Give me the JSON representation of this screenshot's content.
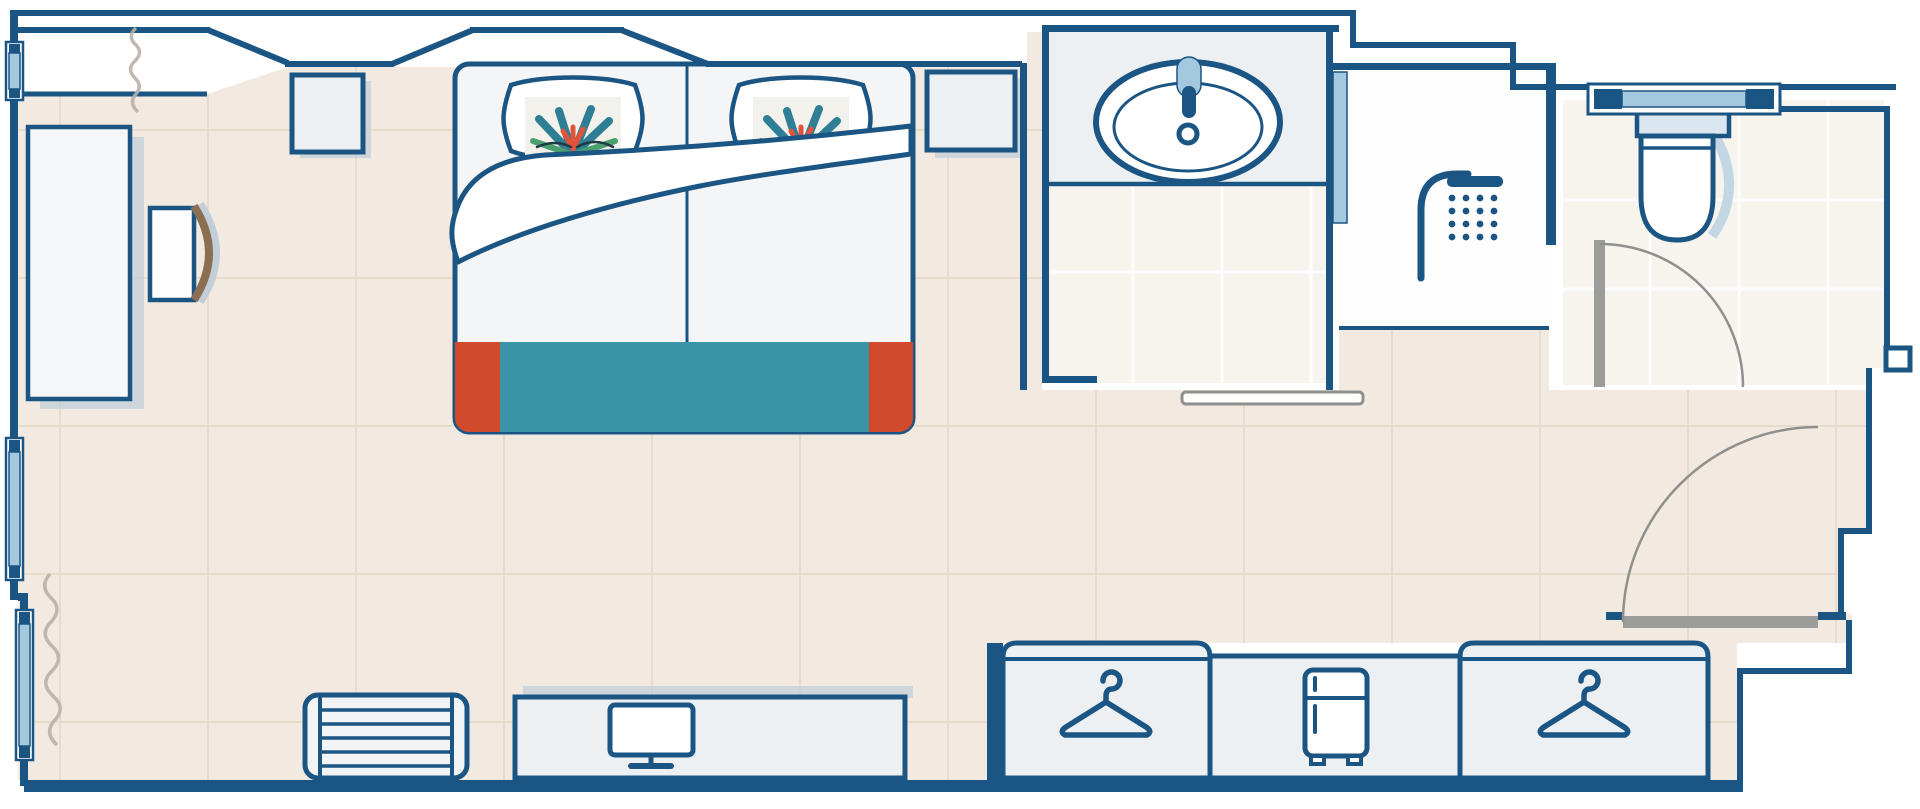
{
  "title": "Hotel room floor plan",
  "colors": {
    "wall": "#1b5583",
    "accent_light_blue": "#a4c9de",
    "mid_blue": "#4a87b0",
    "floor_beige": "#f2e9e0",
    "floor_grid": "#e6d9c9",
    "bath_floor": "#f7f4ee",
    "furniture_fill": "#edf0f2",
    "white": "#ffffff",
    "bedding_teal": "#3a93a6",
    "bedding_orange": "#d14a2b",
    "door_gray": "#9c9c9a",
    "arc_gray": "#8f8f8d",
    "shadow_blue": "#c2cfd9",
    "chair_wood": "#8a6f52",
    "curtain_gray": "#b8b1a8",
    "toilet_shadow": "#c3d6e4",
    "pillow_teal": "#2e7e96",
    "pillow_green": "#4ba06f",
    "pillow_red": "#e0543c"
  },
  "rooms": {
    "bedroom": {
      "label": "Bedroom with double bed"
    },
    "bathroom": {
      "label": "Bathroom with washbasin vanity"
    },
    "shower": {
      "label": "Walk-in shower room"
    },
    "toilet": {
      "label": "Separate toilet room"
    },
    "entry": {
      "label": "Entrance hallway"
    },
    "closet": {
      "label": "Wardrobe corridor"
    }
  },
  "furniture": {
    "bed": {
      "label": "Double bed with duvet and teal runner"
    },
    "pillow_left": {
      "label": "Pillow with tropical print"
    },
    "pillow_right": {
      "label": "Pillow with tropical print"
    },
    "nightstand_left": {
      "label": "Left nightstand"
    },
    "nightstand_right": {
      "label": "Right nightstand"
    },
    "desk": {
      "label": "Desk"
    },
    "desk_chair": {
      "label": "Desk chair"
    },
    "luggage_rack": {
      "label": "Luggage rack"
    },
    "tv_console": {
      "label": "TV console"
    },
    "tv": {
      "label": "Television"
    },
    "wardrobe_left": {
      "label": "Wardrobe with clothes hanger"
    },
    "minibar": {
      "label": "Minibar fridge"
    },
    "wardrobe_right": {
      "label": "Wardrobe with clothes hanger"
    },
    "washbasin": {
      "label": "Washbasin"
    },
    "shower_head": {
      "label": "Shower"
    },
    "toilet_wc": {
      "label": "Toilet"
    },
    "entry_door": {
      "label": "Entrance door with swing arc"
    },
    "toilet_door": {
      "label": "Toilet door with swing arc"
    },
    "sliding_door": {
      "label": "Bathroom sliding door"
    },
    "window_left_top": {
      "label": "Window"
    },
    "window_left_mid": {
      "label": "Window"
    },
    "window_left_low": {
      "label": "Window"
    },
    "window_toilet": {
      "label": "Toilet window"
    },
    "curtain_top": {
      "label": "Curtain"
    },
    "curtain_bottom": {
      "label": "Curtain"
    }
  },
  "icons": {
    "hanger": "hanger-icon",
    "shower": "shower-head-icon",
    "fridge": "fridge-icon",
    "tv": "tv-icon",
    "basin": "washbasin-icon",
    "toilet": "toilet-icon"
  }
}
